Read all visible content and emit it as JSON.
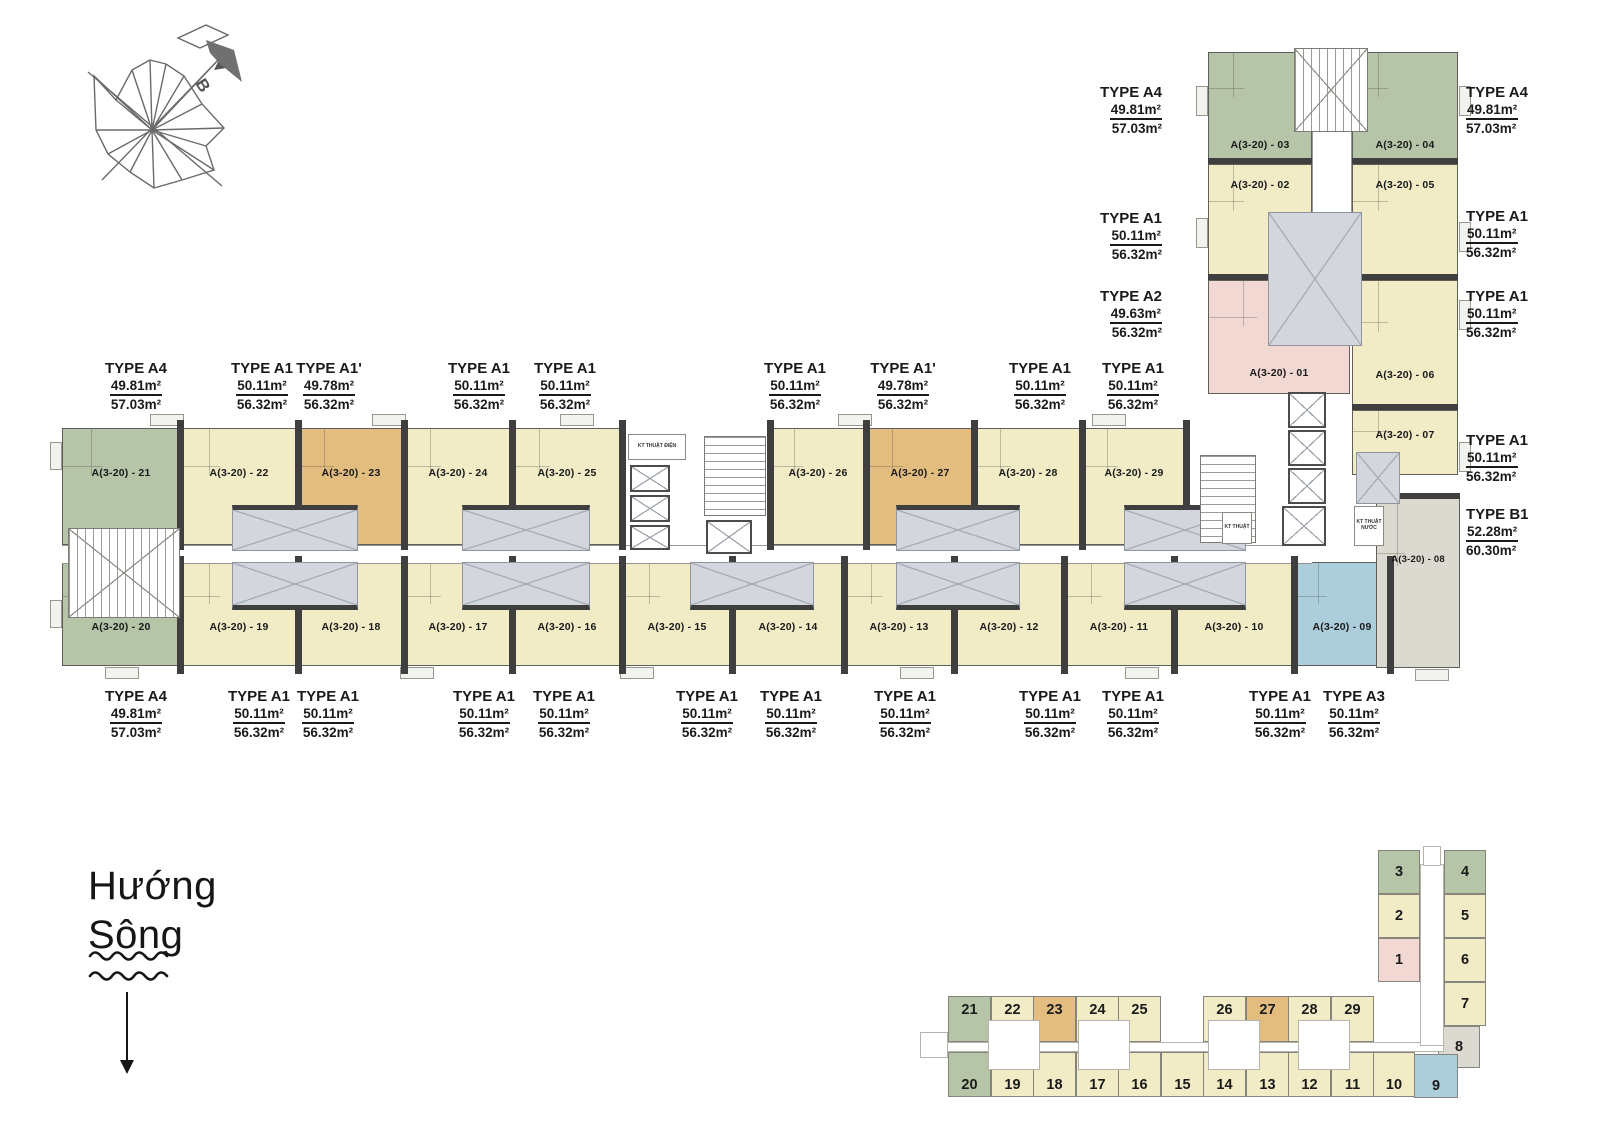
{
  "compass": {
    "north_label": "B"
  },
  "river": {
    "line1": "Hướng",
    "line2": "Sông"
  },
  "units": {
    "bar_top": [
      "A(3-20) - 21",
      "A(3-20) - 22",
      "A(3-20) - 23",
      "A(3-20) - 24",
      "A(3-20) - 25",
      "A(3-20) - 26",
      "A(3-20) - 27",
      "A(3-20) - 28",
      "A(3-20) - 29"
    ],
    "bar_bottom": [
      "A(3-20) - 20",
      "A(3-20) - 19",
      "A(3-20) - 18",
      "A(3-20) - 17",
      "A(3-20) - 16",
      "A(3-20) - 15",
      "A(3-20) - 14",
      "A(3-20) - 13",
      "A(3-20) - 12",
      "A(3-20) - 11",
      "A(3-20) - 10",
      "A(3-20) - 09"
    ],
    "wing_left": [
      "A(3-20) - 03",
      "A(3-20) - 02",
      "A(3-20) - 01"
    ],
    "wing_right": [
      "A(3-20) - 04",
      "A(3-20) - 05",
      "A(3-20) - 06",
      "A(3-20) - 07",
      "A(3-20) - 08"
    ]
  },
  "type_labels": {
    "bar_top": [
      {
        "type": "TYPE A4",
        "area1": "49.81m²",
        "area2": "57.03m²"
      },
      {
        "type": "TYPE A1",
        "area1": "50.11m²",
        "area2": "56.32m²"
      },
      {
        "type": "TYPE A1'",
        "area1": "49.78m²",
        "area2": "56.32m²"
      },
      {
        "type": "TYPE A1",
        "area1": "50.11m²",
        "area2": "56.32m²"
      },
      {
        "type": "TYPE A1",
        "area1": "50.11m²",
        "area2": "56.32m²"
      },
      {
        "type": "TYPE A1",
        "area1": "50.11m²",
        "area2": "56.32m²"
      },
      {
        "type": "TYPE A1'",
        "area1": "49.78m²",
        "area2": "56.32m²"
      },
      {
        "type": "TYPE A1",
        "area1": "50.11m²",
        "area2": "56.32m²"
      },
      {
        "type": "TYPE A1",
        "area1": "50.11m²",
        "area2": "56.32m²"
      }
    ],
    "bar_bottom": [
      {
        "type": "TYPE A4",
        "area1": "49.81m²",
        "area2": "57.03m²"
      },
      {
        "type": "TYPE A1",
        "area1": "50.11m²",
        "area2": "56.32m²"
      },
      {
        "type": "TYPE A1",
        "area1": "50.11m²",
        "area2": "56.32m²"
      },
      {
        "type": "TYPE A1",
        "area1": "50.11m²",
        "area2": "56.32m²"
      },
      {
        "type": "TYPE A1",
        "area1": "50.11m²",
        "area2": "56.32m²"
      },
      {
        "type": "TYPE A1",
        "area1": "50.11m²",
        "area2": "56.32m²"
      },
      {
        "type": "TYPE A1",
        "area1": "50.11m²",
        "area2": "56.32m²"
      },
      {
        "type": "TYPE A1",
        "area1": "50.11m²",
        "area2": "56.32m²"
      },
      {
        "type": "TYPE A1",
        "area1": "50.11m²",
        "area2": "56.32m²"
      },
      {
        "type": "TYPE A1",
        "area1": "50.11m²",
        "area2": "56.32m²"
      },
      {
        "type": "TYPE A1",
        "area1": "50.11m²",
        "area2": "56.32m²"
      },
      {
        "type": "TYPE A3",
        "area1": "50.11m²",
        "area2": "56.32m²"
      }
    ],
    "wing_left": [
      {
        "type": "TYPE A4",
        "area1": "49.81m²",
        "area2": "57.03m²"
      },
      {
        "type": "TYPE A1",
        "area1": "50.11m²",
        "area2": "56.32m²"
      },
      {
        "type": "TYPE A2",
        "area1": "49.63m²",
        "area2": "56.32m²"
      }
    ],
    "wing_right": [
      {
        "type": "TYPE A4",
        "area1": "49.81m²",
        "area2": "57.03m²"
      },
      {
        "type": "TYPE A1",
        "area1": "50.11m²",
        "area2": "56.32m²"
      },
      {
        "type": "TYPE A1",
        "area1": "50.11m²",
        "area2": "56.32m²"
      },
      {
        "type": "TYPE A1",
        "area1": "50.11m²",
        "area2": "56.32m²"
      },
      {
        "type": "TYPE B1",
        "area1": "52.28m²",
        "area2": "60.30m²"
      }
    ]
  },
  "tech_rooms": {
    "electrical": "KT THUẬT ĐIỆN",
    "tech": "KT THUẬT",
    "water": "KT THUẬT NƯỚC"
  },
  "minimap": {
    "bar_top": [
      "21",
      "22",
      "23",
      "24",
      "25",
      "26",
      "27",
      "28",
      "29"
    ],
    "bar_bottom": [
      "20",
      "19",
      "18",
      "17",
      "16",
      "15",
      "14",
      "13",
      "12",
      "11",
      "10",
      "9"
    ],
    "wing_left": [
      "3",
      "2",
      "1"
    ],
    "wing_right": [
      "4",
      "5",
      "6",
      "7",
      "8"
    ]
  },
  "colors": {
    "green": "#b6c5a7",
    "yellow": "#f1ebc6",
    "orange": "#e3bd80",
    "pink": "#f2d8d3",
    "blue": "#accedb",
    "unit_gray": "#dcd9d0",
    "core_gray": "#d3d6dc",
    "wall": "#3f3f3f"
  }
}
